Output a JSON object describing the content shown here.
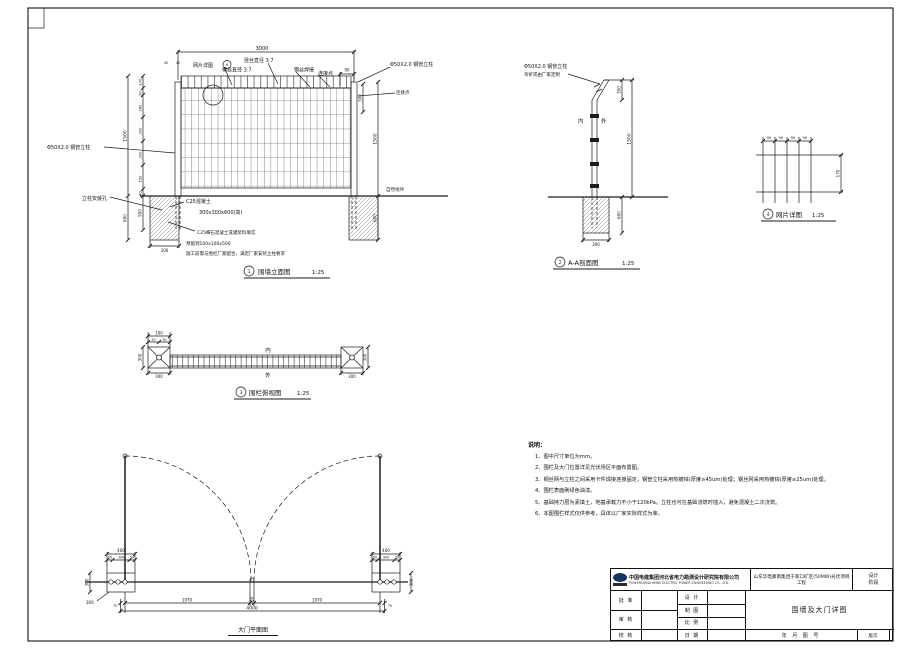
{
  "elevation": {
    "no": "1",
    "title": "围墙立面图",
    "scale": "1:25",
    "dims": {
      "top": "3000",
      "d90": "90",
      "off1": "40",
      "off2": "40",
      "seg1": "170",
      "seg2": "90",
      "seg3": "280",
      "seg4": "300",
      "seg5": "300",
      "seg6": "150",
      "seg7": "40",
      "overall": "1500",
      "below_inner": "500",
      "below_outer": "600",
      "right_300": "300",
      "right_1500": "1500",
      "right_600": "600",
      "found_w": "300"
    },
    "labels": {
      "mesh_ref": "网片详图",
      "mesh_ref_no": "4",
      "wire_v": "竖丝直径 3.7",
      "wire_h": "横丝直径 3.7",
      "weld": "钢丝焊接",
      "joint": "连接点",
      "joint_r": "连接点",
      "post": "Φ50X2.0 钢管立柱",
      "post_l": "Φ50X2.0 钢管立柱",
      "hole": "立柱安装孔",
      "c25": "C25混凝土",
      "c25_size": "300x300x600(高)",
      "grout": "C25细石混凝土或灌浆料填实",
      "reserve": "预留洞100x100x500",
      "coop": "施工前需与围栏厂家配合，满足厂家安装立柱要求",
      "ground": "自然地坪"
    }
  },
  "section": {
    "no": "2",
    "title": "A-A剖面图",
    "scale": "1:25",
    "dims": {
      "bend": "300",
      "height": "1500",
      "embed": "600",
      "found_w": "300"
    },
    "labels": {
      "post": "Φ50X2.0 钢管立柱",
      "bend": "弯折或由厂家定制",
      "inner": "内",
      "outer": "外"
    }
  },
  "mesh": {
    "no": "4",
    "title": "网片详图",
    "scale": "1:25",
    "dims": {
      "w": "90",
      "h": "170"
    }
  },
  "plan": {
    "no": "3",
    "title": "围栏俯视图",
    "scale": "1:25",
    "dims": {
      "top": "100",
      "sub": "50",
      "left": "300",
      "bottom_l": "300",
      "right": "300",
      "bottom_r": "300"
    },
    "labels": {
      "inner": "内",
      "outer": "外"
    }
  },
  "gate": {
    "title": "大门平面图",
    "dims": {
      "post": "400",
      "s50": "50",
      "s300": "300",
      "side": "300",
      "leaf": "1970",
      "gap": "60",
      "total": "4000",
      "end": "70",
      "anchor": "300"
    }
  },
  "notes": {
    "heading": "说明：",
    "items": [
      "1、图中尺寸单位为mm。",
      "2、围栏及大门位置详见光伏场区平面布置图。",
      "3、钢丝网与立柱之间采用卡件焊接连接固定，钢管立柱采用热镀锌(厚度≥45um)处理；钢丝网采用热镀锌(厚度≥25um)处理。",
      "4、围栏表面刷绿色油漆。",
      "5、基础持力层为素填土，地基承载力不小于120kPa。立柱也可在基础浇筑时插入，避免混凝土二次浇筑。",
      "6、本图围栏样式仅供参考，具体以厂家实际样式为准。"
    ]
  },
  "titleblock": {
    "company": "中国电建集团河北省电力勘测设计研究院有限公司",
    "company_en": "POWERCHINA HEBEI ELECTRIC POWER ENGINEERING CO., LTD.",
    "project": "山东华电滕南集团于家口矿区(50MW)光伏项目 工程",
    "drawing": "围墙及大门详图",
    "stage1": "设计",
    "stage2": "阶段",
    "f_approve": "批 准",
    "f_review": "审 核",
    "f_check": "校 核",
    "f_design": "设 计",
    "f_draft": "制 图",
    "f_scale": "比 例",
    "f_date": "日 期",
    "f_ym": "年  月  图  号",
    "f_rev": "版次"
  }
}
